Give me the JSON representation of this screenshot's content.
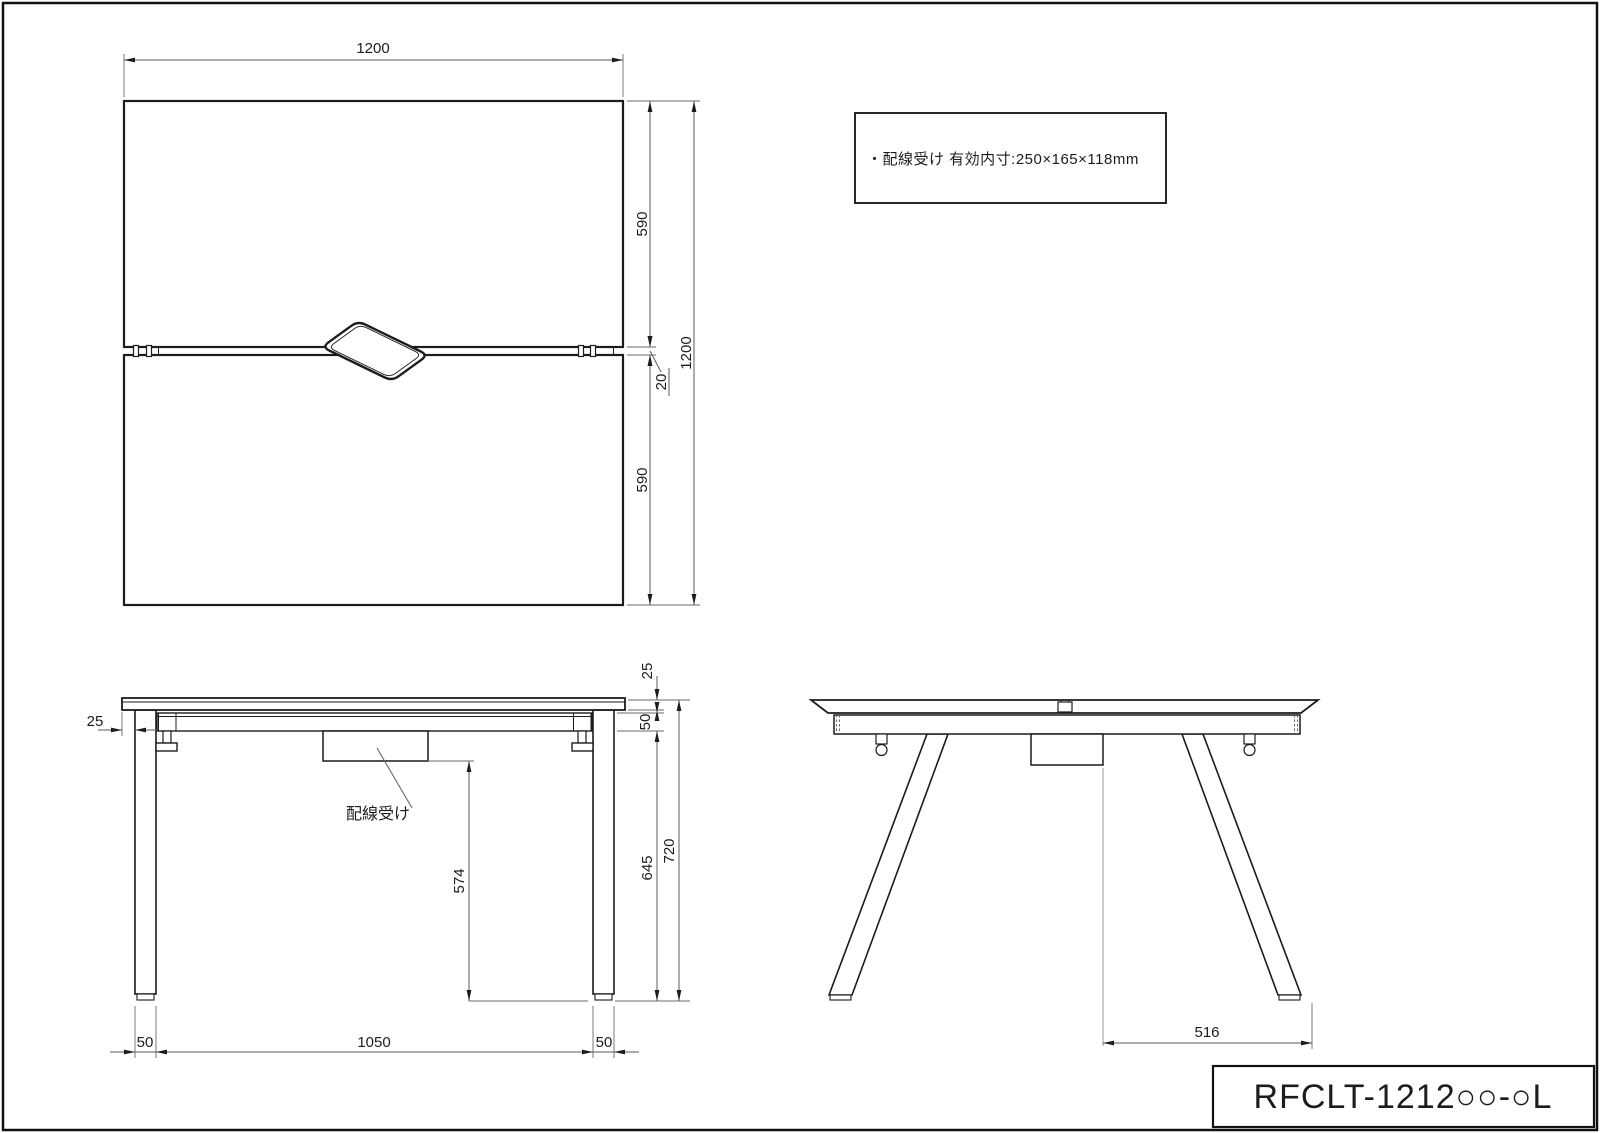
{
  "top_view": {
    "width": "1200",
    "total_depth": "1200",
    "upper_half": "590",
    "center_gap": "20",
    "lower_half": "590"
  },
  "front_view": {
    "top_overhang": "25",
    "top_thickness": "25",
    "frame_height": "50",
    "overall_height": "720",
    "under_frame_to_floor": "645",
    "tray_to_floor": "574",
    "left_leg_width": "50",
    "leg_span": "1050",
    "right_leg_width": "50",
    "cable_tray_label": "配線受け"
  },
  "side_view": {
    "foot_span": "516"
  },
  "note": {
    "text": "・配線受け  有効内寸:250×165×118mm"
  },
  "title_block": {
    "model": "RFCLT-1212○○-○L"
  }
}
